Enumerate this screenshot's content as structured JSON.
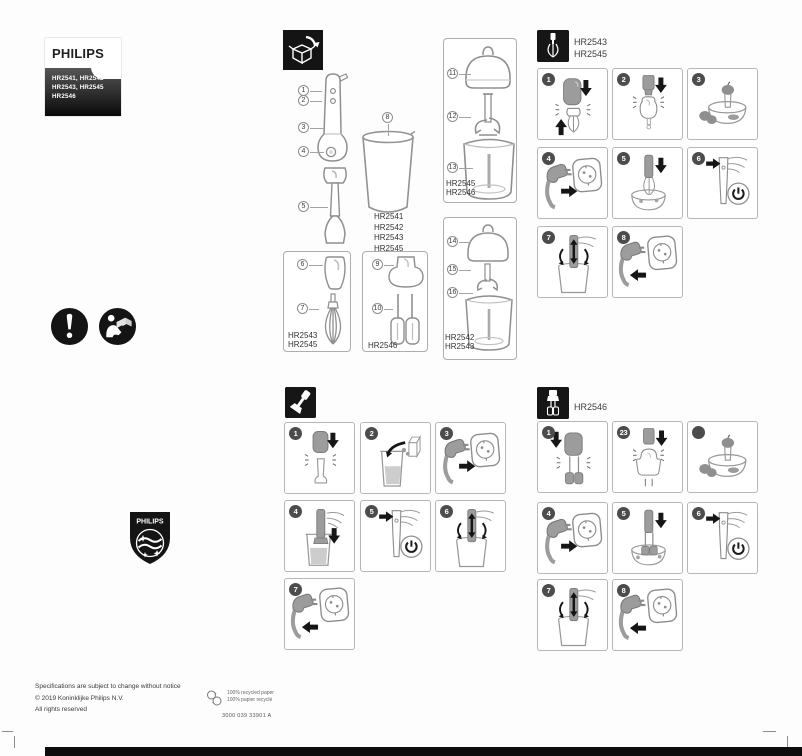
{
  "colors": {
    "brand_dark": "#141414",
    "line_gray": "#8f8f8f",
    "panel_border": "#b6b6b6",
    "badge_bg": "#4c4c4c",
    "arrow_black": "#161616",
    "fill_gray": "#9c9c9c"
  },
  "brand": {
    "name": "PHILIPS",
    "model_lines": [
      "HR2541, HR2542",
      "HR2543, HR2545",
      "HR2546"
    ]
  },
  "shield": {
    "brand": "PHILIPS"
  },
  "icons": {
    "safety": [
      "mandatory-action",
      "read-manual"
    ],
    "headers": [
      "unpack-box",
      "whisk",
      "blender-bar",
      "double-beater"
    ],
    "footer": [
      "recycling-circles"
    ]
  },
  "parts": {
    "callouts": [
      "1",
      "2",
      "3",
      "4",
      "5",
      "6",
      "7",
      "8",
      "9",
      "10",
      "11",
      "12",
      "13",
      "14",
      "15",
      "16"
    ],
    "beaker_models": [
      "HR2541",
      "HR2542",
      "HR2543",
      "HR2545"
    ],
    "whisk_box_models": [
      "HR2543",
      "HR2545"
    ],
    "beater_box_models": [
      "HR2546"
    ],
    "chopper_large_models": [
      "HR2545",
      "HR2546"
    ],
    "chopper_small_models": [
      "HR2542",
      "HR2543"
    ]
  },
  "sections": {
    "whisk": {
      "model_lines": [
        "HR2543",
        "HR2545"
      ],
      "steps": [
        "1",
        "2",
        "3",
        "4",
        "5",
        "6",
        "7",
        "8"
      ]
    },
    "blend": {
      "steps": [
        "1",
        "2",
        "3",
        "4",
        "5",
        "6",
        "7"
      ]
    },
    "beater": {
      "model_lines": [
        "HR2546"
      ],
      "steps": [
        "1",
        "23",
        "",
        "4",
        "5",
        "6",
        "7",
        "8"
      ]
    }
  },
  "footer": {
    "line1": "Specifications are subject to change without notice",
    "line2": "© 2019 Koninklijke Philips N.V.",
    "line3": "All rights reserved",
    "recycle_lines": [
      "100% recycled paper",
      "100% papier recyclé"
    ],
    "doc_code": "3000 039 33901 A"
  }
}
